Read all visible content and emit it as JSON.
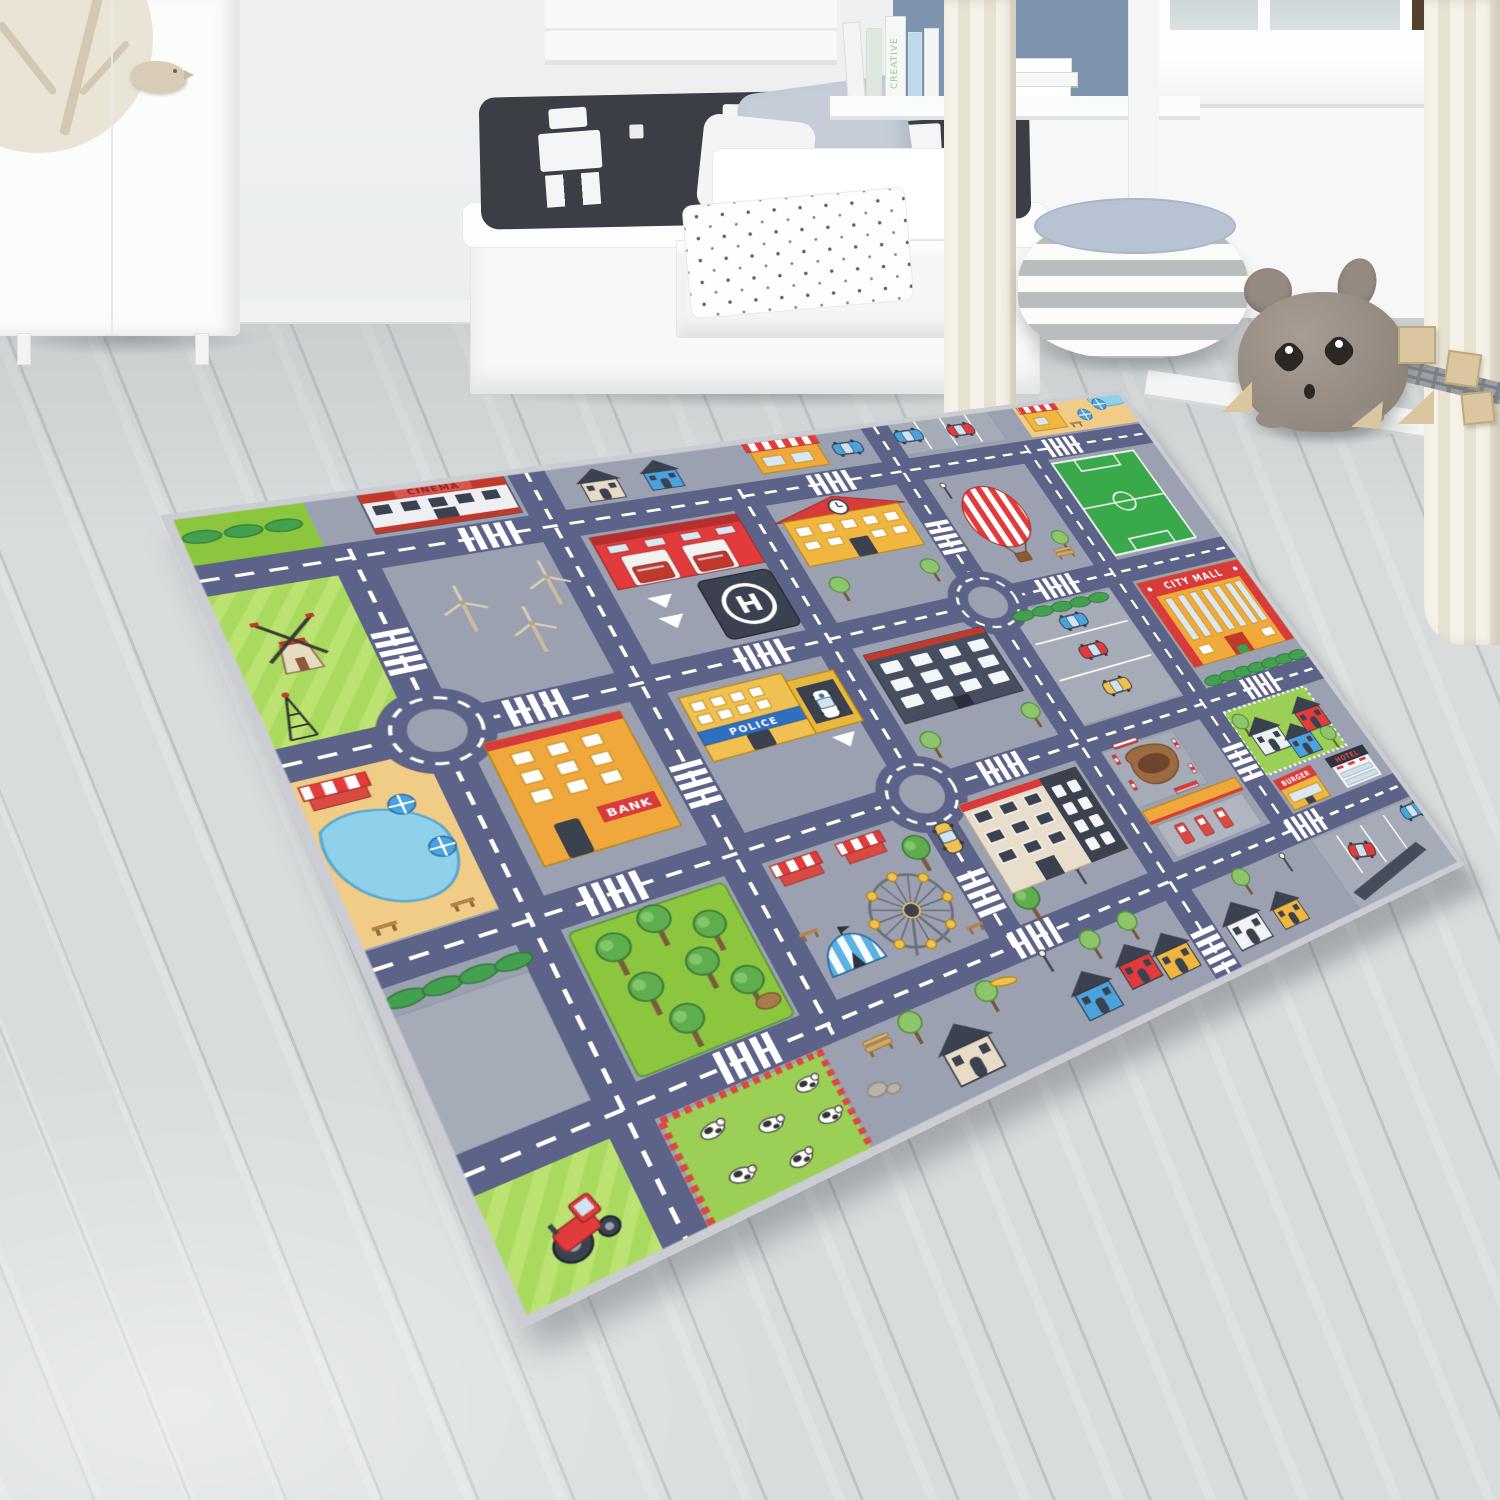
{
  "meta": {
    "description": "Product photo of a children's city traffic play rug lying on grey wood flooring in a white kids bedroom",
    "scene_type": "kids bedroom interior"
  },
  "room": {
    "wall_color": "#eceff0",
    "floor_color": "#d6dadb",
    "book_label": "CREATIVE",
    "items": {
      "wardrobe": "white wardrobe with tree decal and bird handle",
      "bench_bed": "white storage bench with black graphic pillow",
      "bed": "white bed with grey pillow and book shelf",
      "drawer": "open drawer with leaf pattern blanket",
      "window": "white window with sill",
      "curtains": "cream curtains",
      "pouf": "grey and white striped pouf with light blue top",
      "plush": "grey plush mouse toy",
      "blocks": "wooden toy blocks",
      "train_track": "grey toy train track"
    }
  },
  "rug": {
    "type": "city traffic play rug",
    "signs": {
      "cinema": "CINEMA",
      "bank": "BANK",
      "police": "POLICE",
      "helipad": "H",
      "city_mall": "CITY MALL",
      "burger": "BURGER",
      "hotel": "HOTEL"
    },
    "colors": {
      "road": "#5d6388",
      "ground": "#9ba1b1",
      "marking": "#ffffff",
      "grass": "#8cc63f",
      "field": "#aad95f",
      "sand": "#f1cc86",
      "water": "#8fd0ea",
      "roof_red": "#d93a3b",
      "building_orange": "#f2a93b",
      "building_yellow": "#f0b63f",
      "dark": "#3c4150"
    },
    "landmarks": [
      "windmill farm",
      "antenna tower",
      "wind turbines",
      "fire station",
      "helipad",
      "police station",
      "bank",
      "school with clock",
      "cinema",
      "city mall",
      "burger shop",
      "hotel",
      "gas station",
      "construction site",
      "ferris wheel",
      "circus tent",
      "market stalls",
      "hot air balloon",
      "soccer field",
      "pond with beach umbrellas",
      "tree park",
      "cow pasture",
      "tractor field",
      "family houses",
      "parking lots"
    ],
    "counts": {
      "roundabouts": 3,
      "cows": 6,
      "wind_turbines": 3,
      "beach_umbrellas": 4,
      "parked_cars": 10
    }
  }
}
